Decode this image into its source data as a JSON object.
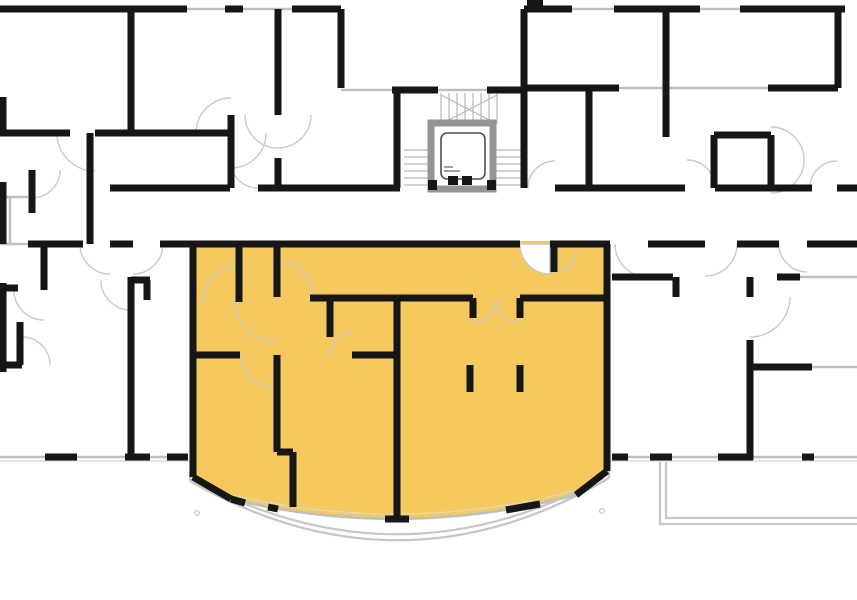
{
  "floorplan": {
    "canvas": {
      "w": 857,
      "h": 600
    },
    "colors": {
      "background": "#ffffff",
      "wall": "#161616",
      "highlight": "#f6c95f",
      "glass": "#bfbfbf",
      "thin": "#d8d8d8",
      "door": "#c9c9c9",
      "stair": "#b8b8b8",
      "balcony": "#c6c6c6",
      "shaft": "#949494",
      "car": "#4f4f4f",
      "pie_fill": "#ffffff"
    },
    "highlight_unit": {
      "fill_path": "M 190,241 L 610,241 L 610,471 L 576,495 Q 401.5,540.5 231,499 L 190,477 Z"
    },
    "walls": [
      [
        0,
        9,
        187,
        9
      ],
      [
        225,
        9,
        243,
        9
      ],
      [
        292,
        9,
        341,
        9
      ],
      [
        341,
        9,
        341,
        88
      ],
      [
        392,
        90,
        438,
        90
      ],
      [
        487,
        90,
        524,
        90
      ],
      [
        524,
        9,
        524,
        188
      ],
      [
        131,
        9,
        131,
        133
      ],
      [
        0,
        133,
        70,
        133
      ],
      [
        95,
        133,
        228,
        133
      ],
      [
        231,
        115,
        231,
        133
      ],
      [
        231,
        133,
        231,
        188
      ],
      [
        278,
        9,
        278,
        115
      ],
      [
        278,
        158,
        278,
        188
      ],
      [
        90,
        133,
        90,
        244
      ],
      [
        32,
        170,
        32,
        213
      ],
      [
        110,
        188,
        230,
        188
      ],
      [
        258,
        188,
        400,
        188
      ],
      [
        397,
        90,
        397,
        188
      ],
      [
        527,
        3,
        543,
        3
      ],
      [
        524,
        9,
        572,
        9
      ],
      [
        614,
        9,
        700,
        9
      ],
      [
        740,
        9,
        845,
        9
      ],
      [
        666,
        9,
        666,
        137
      ],
      [
        524,
        88,
        619,
        88
      ],
      [
        589,
        88,
        589,
        188
      ],
      [
        768,
        88,
        838,
        88
      ],
      [
        838,
        9,
        838,
        88
      ],
      [
        714,
        135,
        771,
        135
      ],
      [
        714,
        135,
        714,
        188
      ],
      [
        771,
        135,
        771,
        188
      ],
      [
        555,
        188,
        685,
        188
      ],
      [
        715,
        188,
        812,
        188
      ],
      [
        837,
        188,
        857,
        188
      ],
      [
        28,
        244,
        83,
        244
      ],
      [
        110,
        244,
        133,
        244
      ],
      [
        160,
        244,
        190,
        244
      ],
      [
        648,
        244,
        705,
        244
      ],
      [
        737,
        244,
        779,
        244
      ],
      [
        807,
        244,
        857,
        244
      ],
      [
        131,
        277,
        131,
        460
      ],
      [
        131,
        280,
        150,
        280
      ],
      [
        147,
        280,
        147,
        300
      ],
      [
        0,
        288,
        18,
        288
      ],
      [
        44,
        247,
        44,
        290
      ],
      [
        0,
        365,
        22,
        365
      ],
      [
        20,
        322,
        20,
        365
      ],
      [
        45,
        457,
        77,
        457
      ],
      [
        125,
        457,
        150,
        457
      ],
      [
        167,
        457,
        188,
        457
      ],
      [
        612,
        277,
        673,
        277
      ],
      [
        676,
        277,
        676,
        297
      ],
      [
        750,
        277,
        750,
        297
      ],
      [
        750,
        340,
        750,
        460
      ],
      [
        753,
        367,
        812,
        367
      ],
      [
        777,
        277,
        800,
        277
      ],
      [
        612,
        457,
        628,
        457
      ],
      [
        650,
        457,
        672,
        457
      ],
      [
        718,
        457,
        753,
        457
      ],
      [
        802,
        457,
        814,
        457
      ],
      [
        3,
        97,
        3,
        133
      ],
      [
        3,
        182,
        3,
        244
      ],
      [
        3,
        283,
        3,
        372
      ],
      [
        190,
        244,
        520,
        244
      ],
      [
        550,
        244,
        610,
        244
      ],
      [
        193,
        244,
        193,
        477
      ],
      [
        193,
        477,
        231,
        499
      ],
      [
        607,
        244,
        607,
        471
      ],
      [
        607,
        471,
        576,
        495
      ],
      [
        540,
        504,
        506,
        510
      ],
      [
        409,
        519,
        385,
        519
      ],
      [
        278,
        509,
        268,
        507
      ],
      [
        245,
        503,
        231,
        499
      ],
      [
        239,
        244,
        239,
        302
      ],
      [
        277,
        244,
        277,
        297
      ],
      [
        193,
        355,
        240,
        355
      ],
      [
        277,
        355,
        277,
        452
      ],
      [
        277,
        452,
        293,
        452
      ],
      [
        293,
        452,
        293,
        507
      ],
      [
        310,
        298,
        473,
        298
      ],
      [
        330,
        298,
        330,
        337
      ],
      [
        352,
        355,
        400,
        355
      ],
      [
        397,
        298,
        397,
        519
      ],
      [
        520,
        298,
        610,
        298
      ],
      [
        554,
        244,
        554,
        272
      ],
      [
        473,
        298,
        473,
        318
      ],
      [
        520,
        298,
        520,
        318
      ],
      [
        470,
        365,
        470,
        392
      ],
      [
        520,
        365,
        520,
        392
      ]
    ],
    "windows": [
      [
        187,
        9,
        225,
        9
      ],
      [
        243,
        9,
        292,
        9
      ],
      [
        341,
        90,
        392,
        90
      ],
      [
        438,
        90,
        487,
        90
      ],
      [
        572,
        9,
        614,
        9
      ],
      [
        700,
        9,
        740,
        9
      ],
      [
        619,
        88,
        664,
        88
      ],
      [
        668,
        88,
        768,
        88
      ],
      [
        0,
        197,
        28,
        197
      ],
      [
        10,
        197,
        10,
        244
      ],
      [
        0,
        244,
        28,
        244
      ],
      [
        0,
        457,
        45,
        457
      ],
      [
        77,
        457,
        125,
        457
      ],
      [
        150,
        457,
        167,
        457
      ],
      [
        628,
        457,
        650,
        457
      ],
      [
        672,
        457,
        718,
        457
      ],
      [
        753,
        457,
        802,
        457
      ],
      [
        814,
        457,
        857,
        457
      ],
      [
        812,
        367,
        857,
        367
      ],
      [
        800,
        277,
        857,
        277
      ]
    ],
    "thin_lines": [
      [
        0,
        461,
        190,
        461
      ],
      [
        610,
        461,
        857,
        461
      ]
    ],
    "glazing_paths": [
      "M 576,495 Q 401.5,540.5 231,499",
      "M 574,491 Q 401.5,535 233,495"
    ],
    "balcony_paths": [
      "M 190,481 Q 400,601 609,478",
      "M 196,481 Q 400,589 603,478",
      "M 190,472 L 190,481",
      "M 609,470 L 609,478",
      "M 660,462 L 660,524 L 857,524",
      "M 666,462 L 666,518 L 857,518"
    ],
    "balcony_posts": [
      [
        197,
        513
      ],
      [
        602,
        511
      ]
    ],
    "stairs": [
      [
        441,
        93,
        441,
        124
      ],
      [
        449,
        93,
        449,
        124
      ],
      [
        457,
        93,
        457,
        124
      ],
      [
        465,
        93,
        465,
        124
      ],
      [
        473,
        93,
        473,
        124
      ],
      [
        481,
        93,
        481,
        124
      ],
      [
        489,
        93,
        489,
        124
      ],
      [
        497,
        93,
        497,
        124
      ],
      [
        441,
        124,
        497,
        95
      ],
      [
        441,
        95,
        497,
        124
      ],
      [
        432,
        148,
        432,
        188
      ],
      [
        493,
        148,
        493,
        188
      ],
      [
        404,
        150,
        431,
        150
      ],
      [
        404,
        157,
        431,
        157
      ],
      [
        404,
        164,
        431,
        164
      ],
      [
        404,
        171,
        431,
        171
      ],
      [
        404,
        178,
        431,
        178
      ],
      [
        404,
        185,
        431,
        185
      ],
      [
        494,
        150,
        522,
        150
      ],
      [
        494,
        157,
        522,
        157
      ],
      [
        494,
        164,
        522,
        164
      ],
      [
        494,
        171,
        522,
        171
      ],
      [
        494,
        178,
        522,
        178
      ],
      [
        494,
        185,
        522,
        185
      ]
    ],
    "door_arcs": [
      [
        57,
        133,
        38,
        95,
        171,
        0
      ],
      [
        245,
        115,
        33,
        278,
        148,
        0
      ],
      [
        278,
        148,
        33,
        311,
        115,
        0
      ],
      [
        266,
        133,
        35,
        231,
        168,
        1
      ],
      [
        231,
        98,
        35,
        196,
        133,
        0
      ],
      [
        32,
        198,
        28,
        60,
        170,
        0
      ],
      [
        258,
        188,
        28,
        230,
        160,
        1
      ],
      [
        528,
        188,
        27,
        555,
        161,
        1
      ],
      [
        687,
        160,
        28,
        715,
        188,
        1
      ],
      [
        810,
        188,
        27,
        837,
        161,
        1
      ],
      [
        771,
        127,
        33,
        804,
        160,
        1
      ],
      [
        804,
        160,
        33,
        771,
        193,
        1
      ],
      [
        80,
        244,
        30,
        110,
        274,
        0
      ],
      [
        133,
        274,
        30,
        163,
        244,
        0
      ],
      [
        615,
        244,
        33,
        648,
        277,
        0
      ],
      [
        705,
        276,
        32,
        737,
        244,
        0
      ],
      [
        779,
        244,
        28,
        807,
        272,
        0
      ],
      [
        44,
        320,
        30,
        14,
        290,
        1
      ],
      [
        22,
        337,
        28,
        50,
        365,
        1
      ],
      [
        101,
        280,
        30,
        131,
        310,
        0
      ],
      [
        790,
        297,
        40,
        750,
        337,
        1
      ],
      [
        203,
        302,
        36,
        239,
        266,
        1
      ],
      [
        277,
        261,
        36,
        313,
        297,
        1
      ],
      [
        235,
        300,
        42,
        277,
        342,
        0
      ],
      [
        241,
        355,
        32,
        273,
        387,
        0
      ],
      [
        330,
        355,
        22,
        352,
        333,
        1
      ],
      [
        473,
        323,
        23,
        496,
        300,
        0
      ],
      [
        497,
        300,
        23,
        520,
        323,
        0
      ],
      [
        576,
        252,
        20,
        556,
        272,
        1
      ]
    ],
    "door_pies": [
      "M 550,244 L 520,244 A 30 30 0 0 0 550,274 Z"
    ],
    "elevator": {
      "shaft": [
        431,
        123,
        62,
        66
      ],
      "car": [
        441,
        133,
        44,
        46
      ],
      "ticks": [
        [
          448,
          176,
          10,
          9
        ],
        [
          462,
          176,
          10,
          9
        ]
      ],
      "details": [
        [
          444,
          171,
          460,
          171
        ],
        [
          444,
          167,
          453,
          167
        ]
      ],
      "corner_marks": [
        [
          428,
          180,
          9,
          10
        ],
        [
          487,
          180,
          9,
          10
        ]
      ]
    }
  }
}
